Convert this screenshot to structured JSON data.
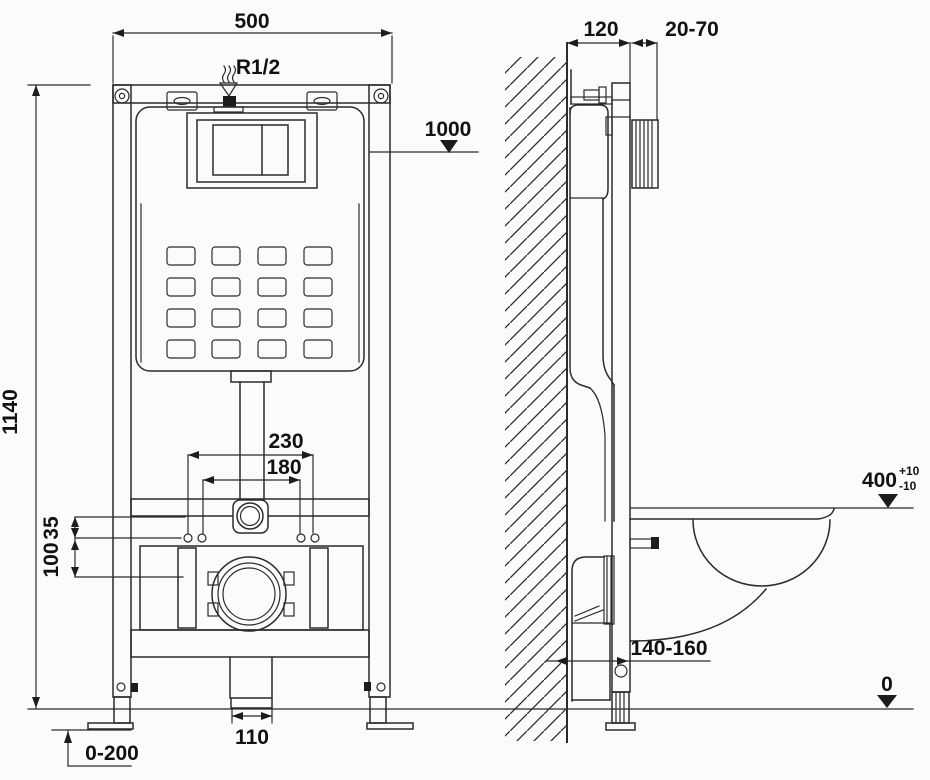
{
  "meta": {
    "description": "Installation drawing of a wall-hung toilet concealed cistern frame: front view (left) and side view with bowl (right)",
    "background_color": "#fbfbfb",
    "line_color": "#2b2b2b",
    "text_color": "#111111"
  },
  "front_view": {
    "width_label": "500",
    "inlet_label": "R1/2",
    "supply_height_label": "1000",
    "frame_height_label": "1140",
    "outer_bolt_spacing_label": "230",
    "inner_bolt_spacing_label": "180",
    "offset_small_label": "35",
    "offset_large_label": "100",
    "drain_pipe_label": "110",
    "feet_adjust_label": "0-200"
  },
  "side_view": {
    "depth_label": "120",
    "panel_range_label": "20-70",
    "bowl_height_label": "400",
    "bowl_height_tol_plus": "+10",
    "bowl_height_tol_minus": "-10",
    "outlet_range_label": "140-160",
    "floor_label": "0"
  }
}
